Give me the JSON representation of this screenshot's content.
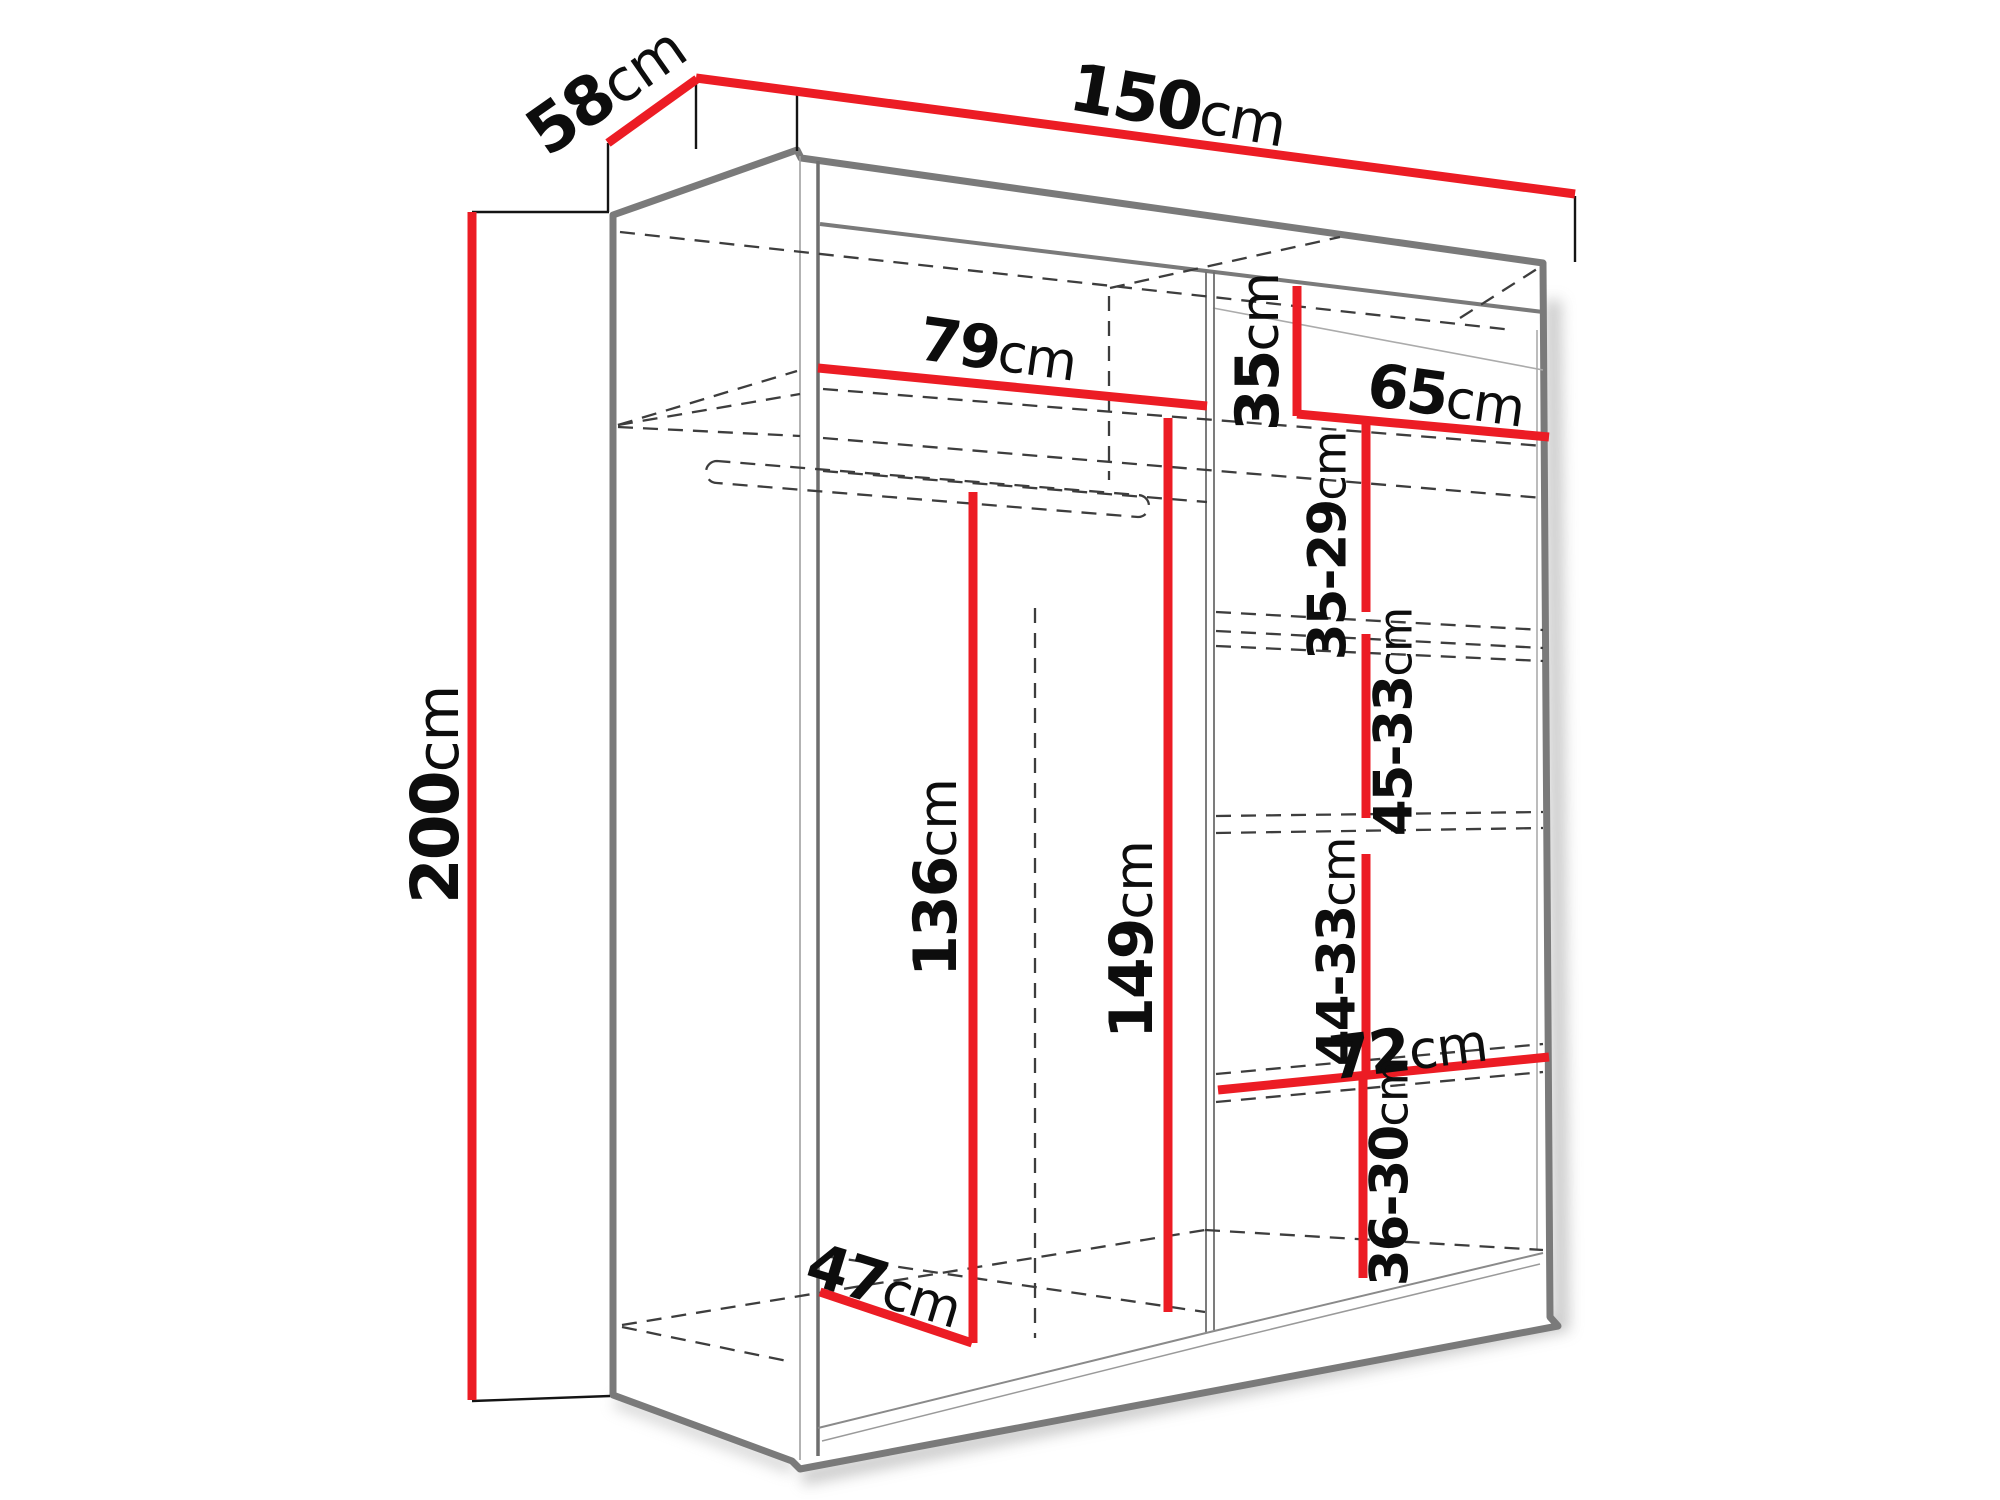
{
  "diagram": {
    "type": "wardrobe-dimension-drawing",
    "unit": "cm",
    "colors": {
      "dimension_line": "#ec1c24",
      "outline": "#7a7a7a",
      "hidden_edge": "#3d3d3d",
      "extension_line": "#141414",
      "background": "#ffffff"
    },
    "dimensions": {
      "depth": {
        "value": "58",
        "unit": "cm",
        "meaning": "overall depth"
      },
      "width": {
        "value": "150",
        "unit": "cm",
        "meaning": "overall width"
      },
      "height": {
        "value": "200",
        "unit": "cm",
        "meaning": "overall height"
      },
      "shelf79": {
        "value": "79",
        "unit": "cm",
        "meaning": "left compartment width"
      },
      "top35": {
        "value": "35",
        "unit": "cm",
        "meaning": "top right section height"
      },
      "shelf65": {
        "value": "65",
        "unit": "cm",
        "meaning": "right compartment width"
      },
      "gap3529": {
        "value": "35-29",
        "unit": "cm",
        "meaning": "shelf gap"
      },
      "gap4533": {
        "value": "45-33",
        "unit": "cm",
        "meaning": "shelf gap"
      },
      "rod136": {
        "value": "136",
        "unit": "cm",
        "meaning": "hanging height left"
      },
      "rod149": {
        "value": "149",
        "unit": "cm",
        "meaning": "interior height"
      },
      "gap4433": {
        "value": "44-33",
        "unit": "cm",
        "meaning": "shelf gap"
      },
      "shelf72": {
        "value": "72",
        "unit": "cm",
        "meaning": "bottom shelf width"
      },
      "gap3630": {
        "value": "36-30",
        "unit": "cm",
        "meaning": "bottom shelf gap"
      },
      "depth47": {
        "value": "47",
        "unit": "cm",
        "meaning": "interior depth"
      }
    }
  }
}
